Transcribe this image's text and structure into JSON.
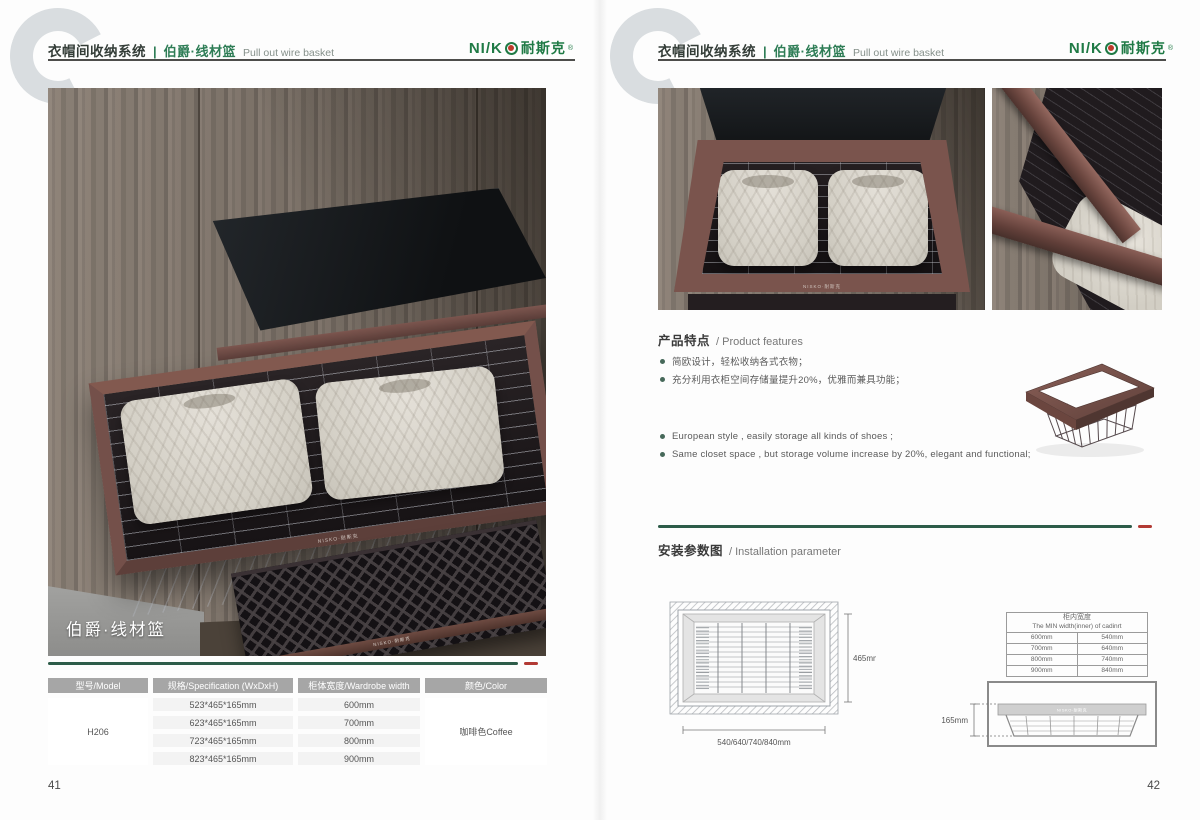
{
  "header": {
    "system_cn": "衣帽间收纳系统",
    "separator": "|",
    "product_cn": "伯爵·线材篮",
    "product_en": "Pull out wire basket"
  },
  "logo": {
    "latin_prefix": "NI/K",
    "cn": "耐斯克",
    "reg": "®",
    "rail_print": "NISKO·耐斯克"
  },
  "colors": {
    "brand_green": "#1f7a45",
    "header_green": "#2e7d56",
    "divider_green": "#2d5c49",
    "divider_red": "#b23a34",
    "coffee_frame": "#74504a",
    "table_header_bg": "#a6a6a6"
  },
  "page_left": {
    "page_number": "41",
    "photo_caption": "伯爵·线材篮",
    "spec_table": {
      "headers": [
        "型号/Model",
        "规格/Specification (WxDxH)",
        "柜体宽度/Wardrobe width",
        "颜色/Color"
      ],
      "model": "H206",
      "color": "咖啡色Coffee",
      "rows": [
        {
          "spec": "523*465*165mm",
          "width": "600mm"
        },
        {
          "spec": "623*465*165mm",
          "width": "700mm"
        },
        {
          "spec": "723*465*165mm",
          "width": "800mm"
        },
        {
          "spec": "823*465*165mm",
          "width": "900mm"
        }
      ]
    }
  },
  "page_right": {
    "page_number": "42",
    "features": {
      "title_cn": "产品特点",
      "title_en": "/ Product features",
      "bullets_cn": [
        "简欧设计，轻松收纳各式衣物；",
        "充分利用衣柜空间存储量提升20%，优雅而兼具功能；"
      ],
      "bullets_en": [
        "European style ,  easily storage all kinds of shoes ;",
        "Same closet space ,  but storage volume increase by 20%, elegant and functional;"
      ]
    },
    "installation": {
      "title_cn": "安装参数图",
      "title_en": "/ Installation parameter",
      "top_view": {
        "depth": "465mm",
        "widths": "540/640/740/840mm"
      },
      "side_view": {
        "height": "165mm"
      },
      "min_width_table": {
        "title_cn": "柜内宽度",
        "title_en": "The MIN width(inner) of cadinrt",
        "rows": [
          {
            "cabinet": "600mm",
            "min_inner": "540mm"
          },
          {
            "cabinet": "700mm",
            "min_inner": "640mm"
          },
          {
            "cabinet": "800mm",
            "min_inner": "740mm"
          },
          {
            "cabinet": "900mm",
            "min_inner": "840mm"
          }
        ]
      }
    }
  }
}
